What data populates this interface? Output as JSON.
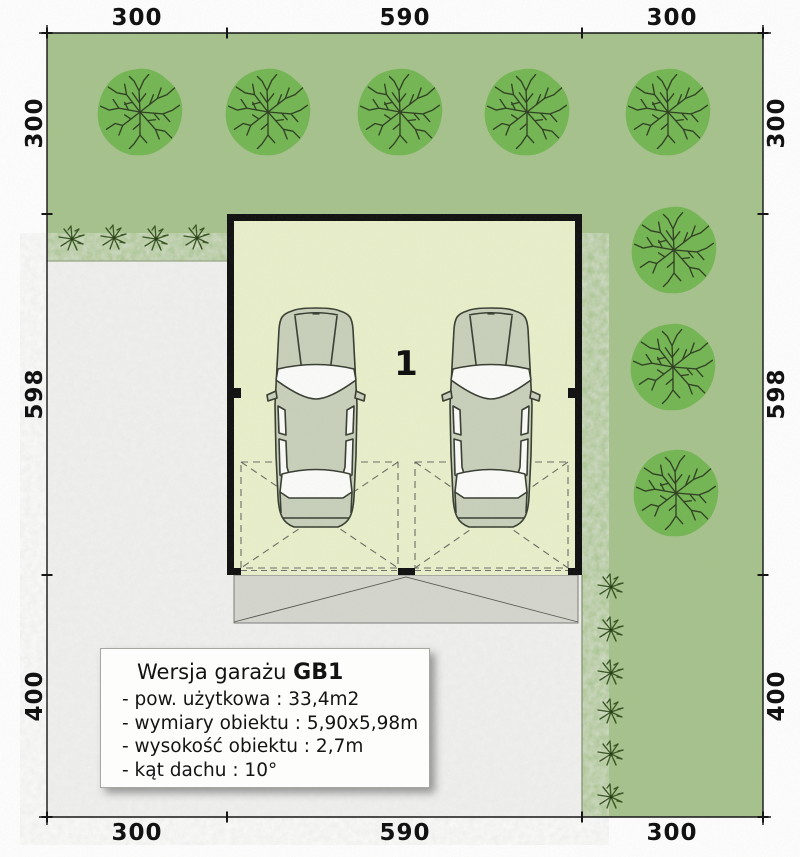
{
  "dimensions": {
    "top": [
      "300",
      "590",
      "300"
    ],
    "bottom": [
      "300",
      "590",
      "300"
    ],
    "left": [
      "300",
      "598",
      "400"
    ],
    "right": [
      "300",
      "598",
      "400"
    ]
  },
  "garage": {
    "unit_label": "1"
  },
  "info_box": {
    "title_prefix": "Wersja garażu",
    "title_code": "GB1",
    "items": [
      "- pow. użytkowa : 33,4m2",
      "- wymiary obiektu : 5,90x5,98m",
      "- wysokość obiektu : 2,7m",
      "- kąt dachu : 10°"
    ]
  },
  "colors": {
    "grass": "#a5c28b",
    "tree_foliage": "#72b551",
    "tree_branch": "#2c3d1e",
    "shrub": "#35521f",
    "garage_floor": "#e9efca",
    "garage_wall": "#0d0d0d",
    "car_body": "#c8cfb9",
    "car_window": "#fbfbf9",
    "paving_apron": "#d4d6ce",
    "driveway": "#f0f0ee",
    "dimension_text": "#121212"
  }
}
